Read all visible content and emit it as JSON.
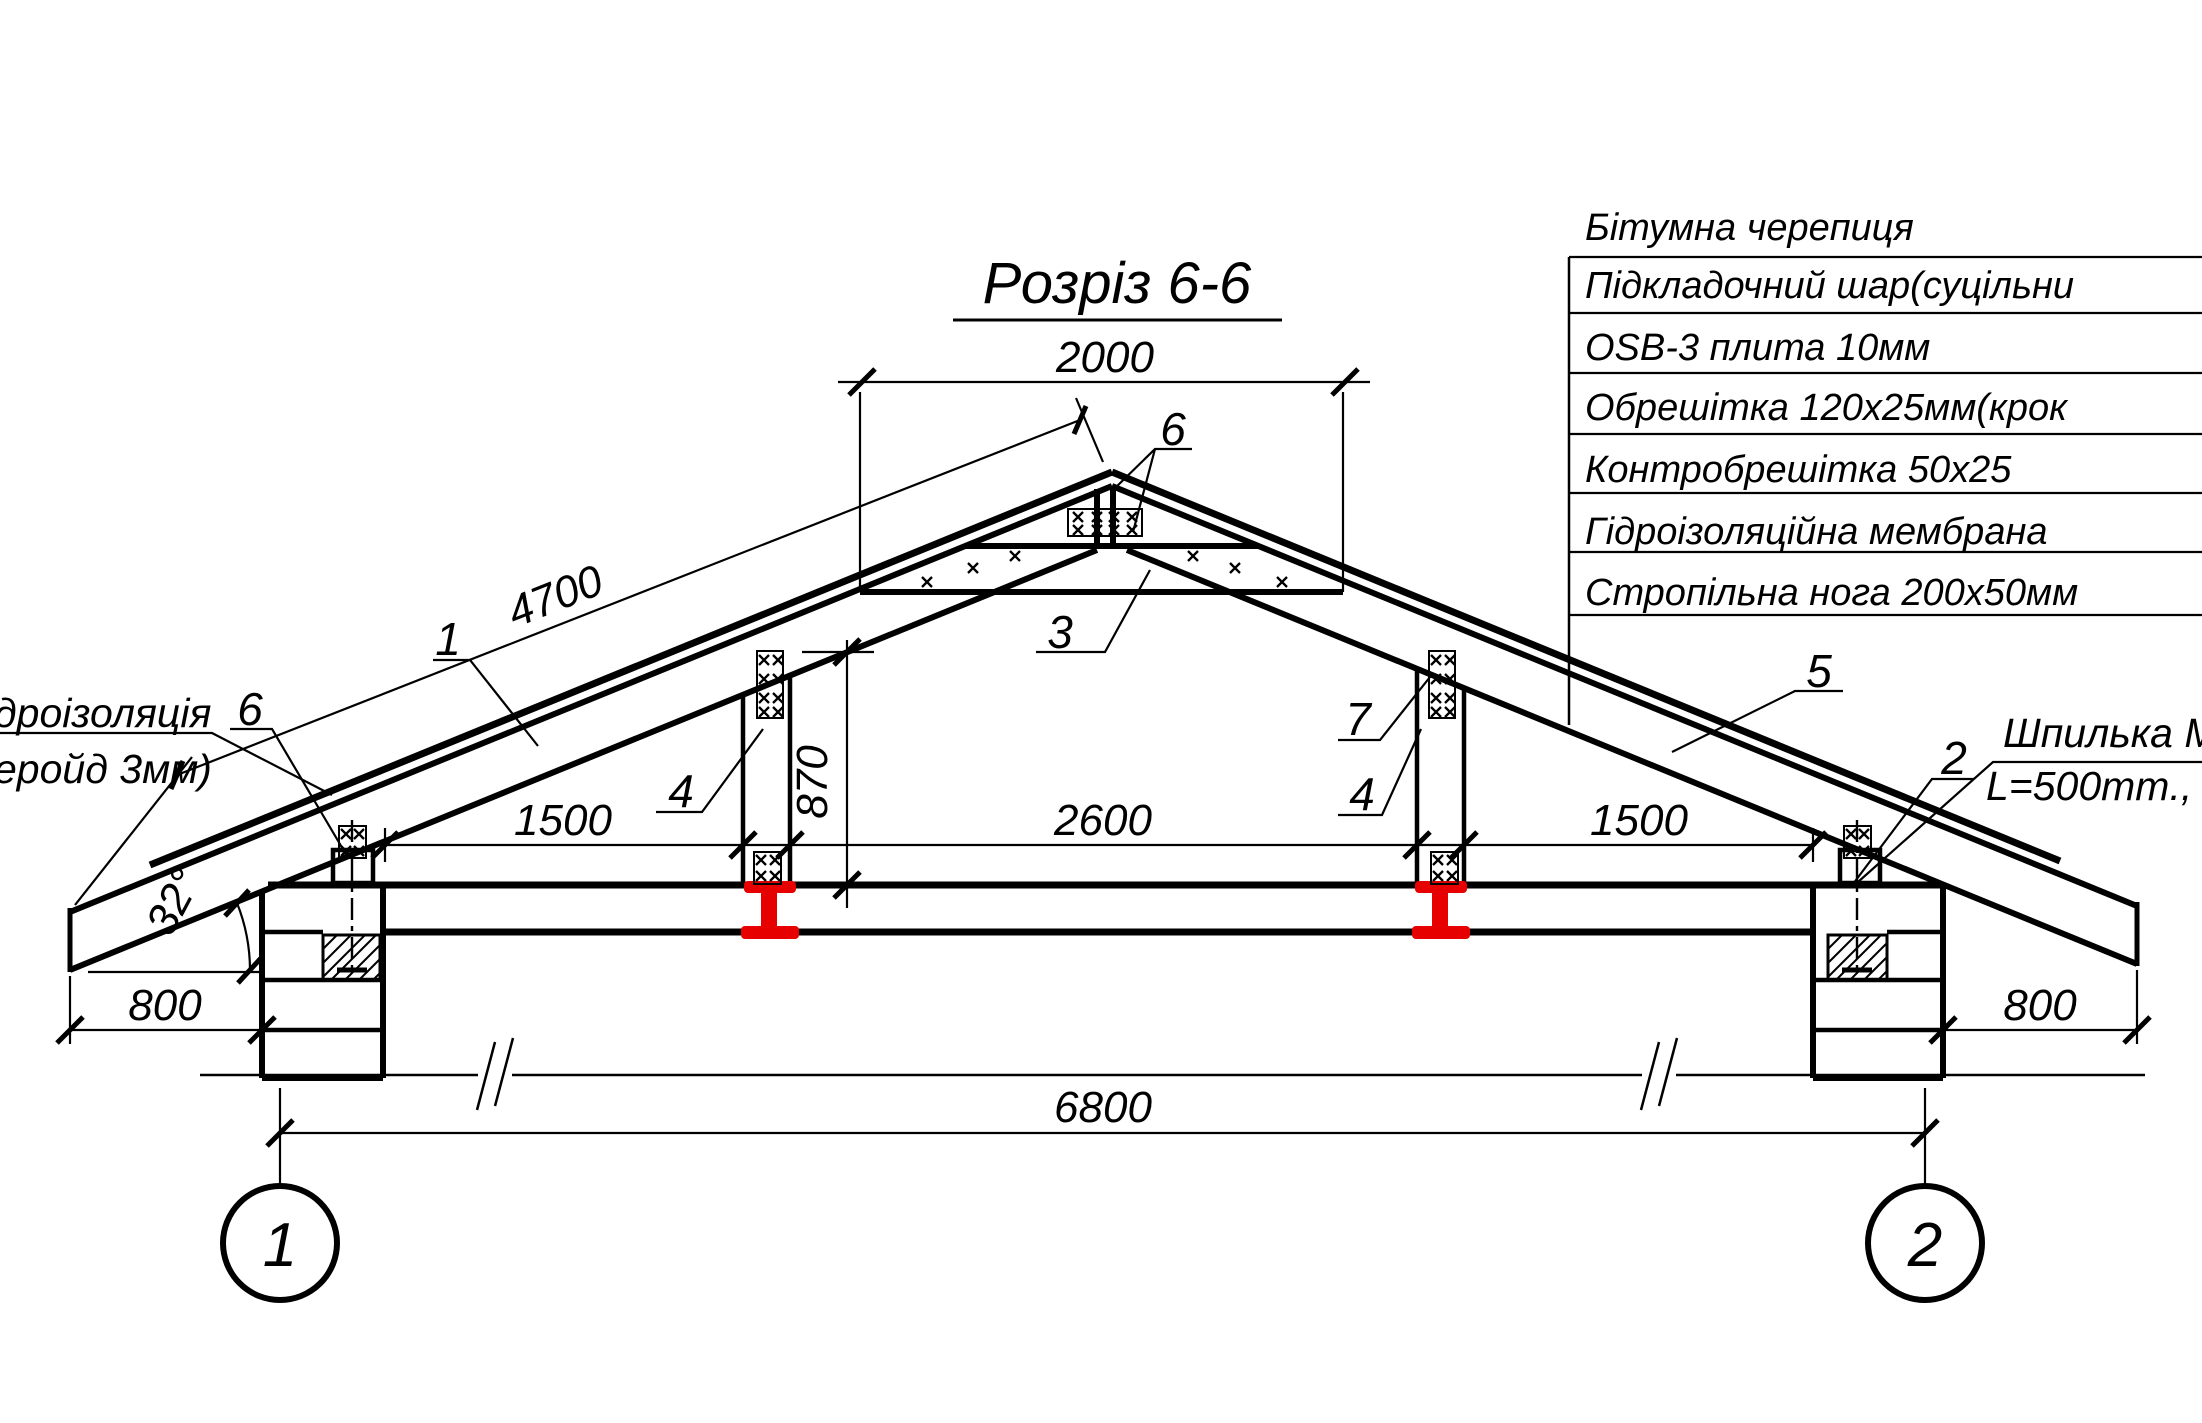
{
  "title": {
    "text": "Розріз 6-6"
  },
  "legend": {
    "rows": [
      {
        "label": "Бітумна черепиця"
      },
      {
        "label": "Підкладочний шар(суцільни"
      },
      {
        "label": "OSB-3 плита 10мм"
      },
      {
        "label": "Обрешітка 120x25мм(крок"
      },
      {
        "label": "Контробрешітка 50x25"
      },
      {
        "label": "Гідроізоляційна мембрана"
      },
      {
        "label": "Стропільна нога 200x50мм"
      }
    ]
  },
  "annotations": {
    "hydro_label_line1": "дроізоляція",
    "hydro_label_line2": "еройд 3мм)",
    "stud_label_line1": "Шпилька М",
    "stud_label_line2": "L=500mm., к"
  },
  "callouts": {
    "rafter_left": "1",
    "anchor_stud": "2",
    "collar_tie": "3",
    "post_left": "4",
    "post_right": "4",
    "rafter_right": "5",
    "plate_ridge": "6",
    "plate_eave": "6",
    "strut": "7"
  },
  "dimensions": {
    "collar_tie_span": "2000",
    "rafter_length": "4700",
    "bay_left": "1500",
    "bay_center": "2600",
    "bay_right": "1500",
    "overhang_left": "800",
    "overhang_right": "800",
    "overall_span": "6800",
    "post_height": "870",
    "roof_angle": "32°"
  },
  "axes": {
    "axis_left": "1",
    "axis_right": "2"
  },
  "colors": {
    "drawing": "#000000",
    "steel_beam": "#e60000",
    "background": "#ffffff"
  }
}
